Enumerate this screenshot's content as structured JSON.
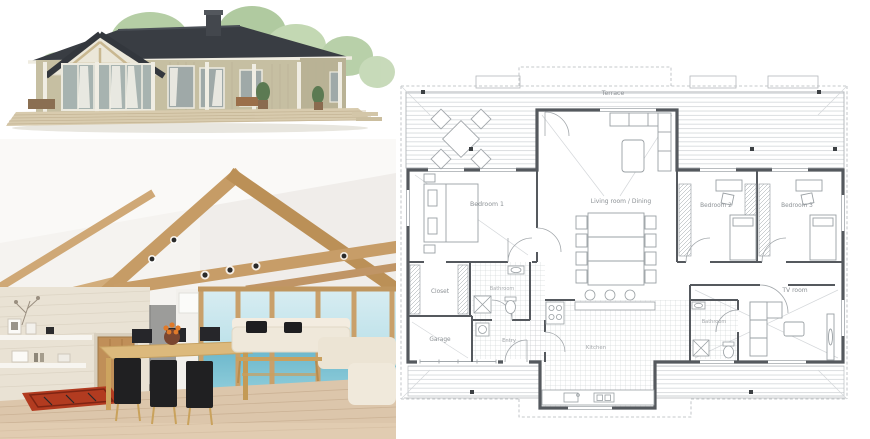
{
  "collage": {
    "exterior": {
      "name": "house exterior 3d render"
    },
    "interior": {
      "name": "living and dining room interior render"
    },
    "plan": {
      "name": "single floor house plan drawing"
    }
  },
  "floor_plan": {
    "labels": {
      "terrace": "Terrace",
      "bedroom1": "Bedroom 1",
      "bedroom2": "Bedroom 2",
      "bedroom3": "Bedroom 3",
      "living": "Living room / Dining",
      "closet": "Closet",
      "bathroom1": "Bathroom",
      "garage": "Garage",
      "entry": "Entry",
      "kitchen": "Kitchen",
      "bathroom2": "Bathroom",
      "tv_room": "TV room"
    },
    "colors": {
      "wall": "#55595e",
      "line": "#a2a7ab",
      "tile": "#c6cacd",
      "deck_line": "#ccd0d3",
      "dash": "#b4b8bb",
      "label": "#8b9094"
    }
  },
  "palette": {
    "roof": "#393d43",
    "siding": "#c6bfa2",
    "deck": "#d8cbae",
    "beam": "#c69c66",
    "wood_floor": "#dcc6ab",
    "rug": "#b23b20",
    "sofa": "#efe8da",
    "sea": "#6fb9cd",
    "dining_chair": "#202022",
    "door": "#c08f58"
  }
}
